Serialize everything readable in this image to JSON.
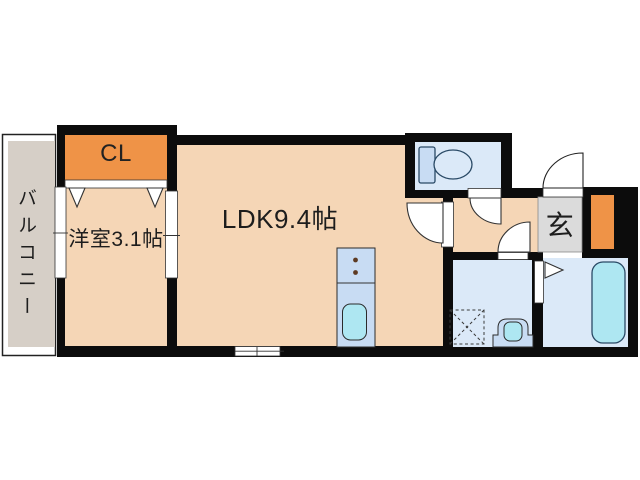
{
  "floor_plan": {
    "balcony": {
      "label": "バルコニー"
    },
    "closet": {
      "label": "CL"
    },
    "western_room": {
      "label": "洋室3.1帖"
    },
    "ldk": {
      "label": "LDK9.4帖"
    },
    "entrance": {
      "label": "玄"
    },
    "fixtures": {
      "toilet": "toilet-icon",
      "bathtub": "bathtub-icon",
      "kitchen_sink": "kitchen-sink-icon",
      "stove_burners": "stove-burners-icon",
      "washbasin": "washbasin-icon",
      "washer_pan": "washing-machine-pan-icon",
      "closet_folding_doors": "folding-door-icon",
      "entry_door": "swing-door-icon"
    },
    "colors": {
      "wall": "#0c0c0c",
      "room_floor": "#f5d6b6",
      "closet_accent": "#ef9347",
      "wet_floor": "#dbe9f8",
      "fixture_blue": "#c8dcf3",
      "water_cyan": "#aee7f2",
      "balcony_grey": "#d6cfc7",
      "entrance_grey": "#dbdbdb",
      "sanitary_outline": "#2a4a66"
    }
  }
}
